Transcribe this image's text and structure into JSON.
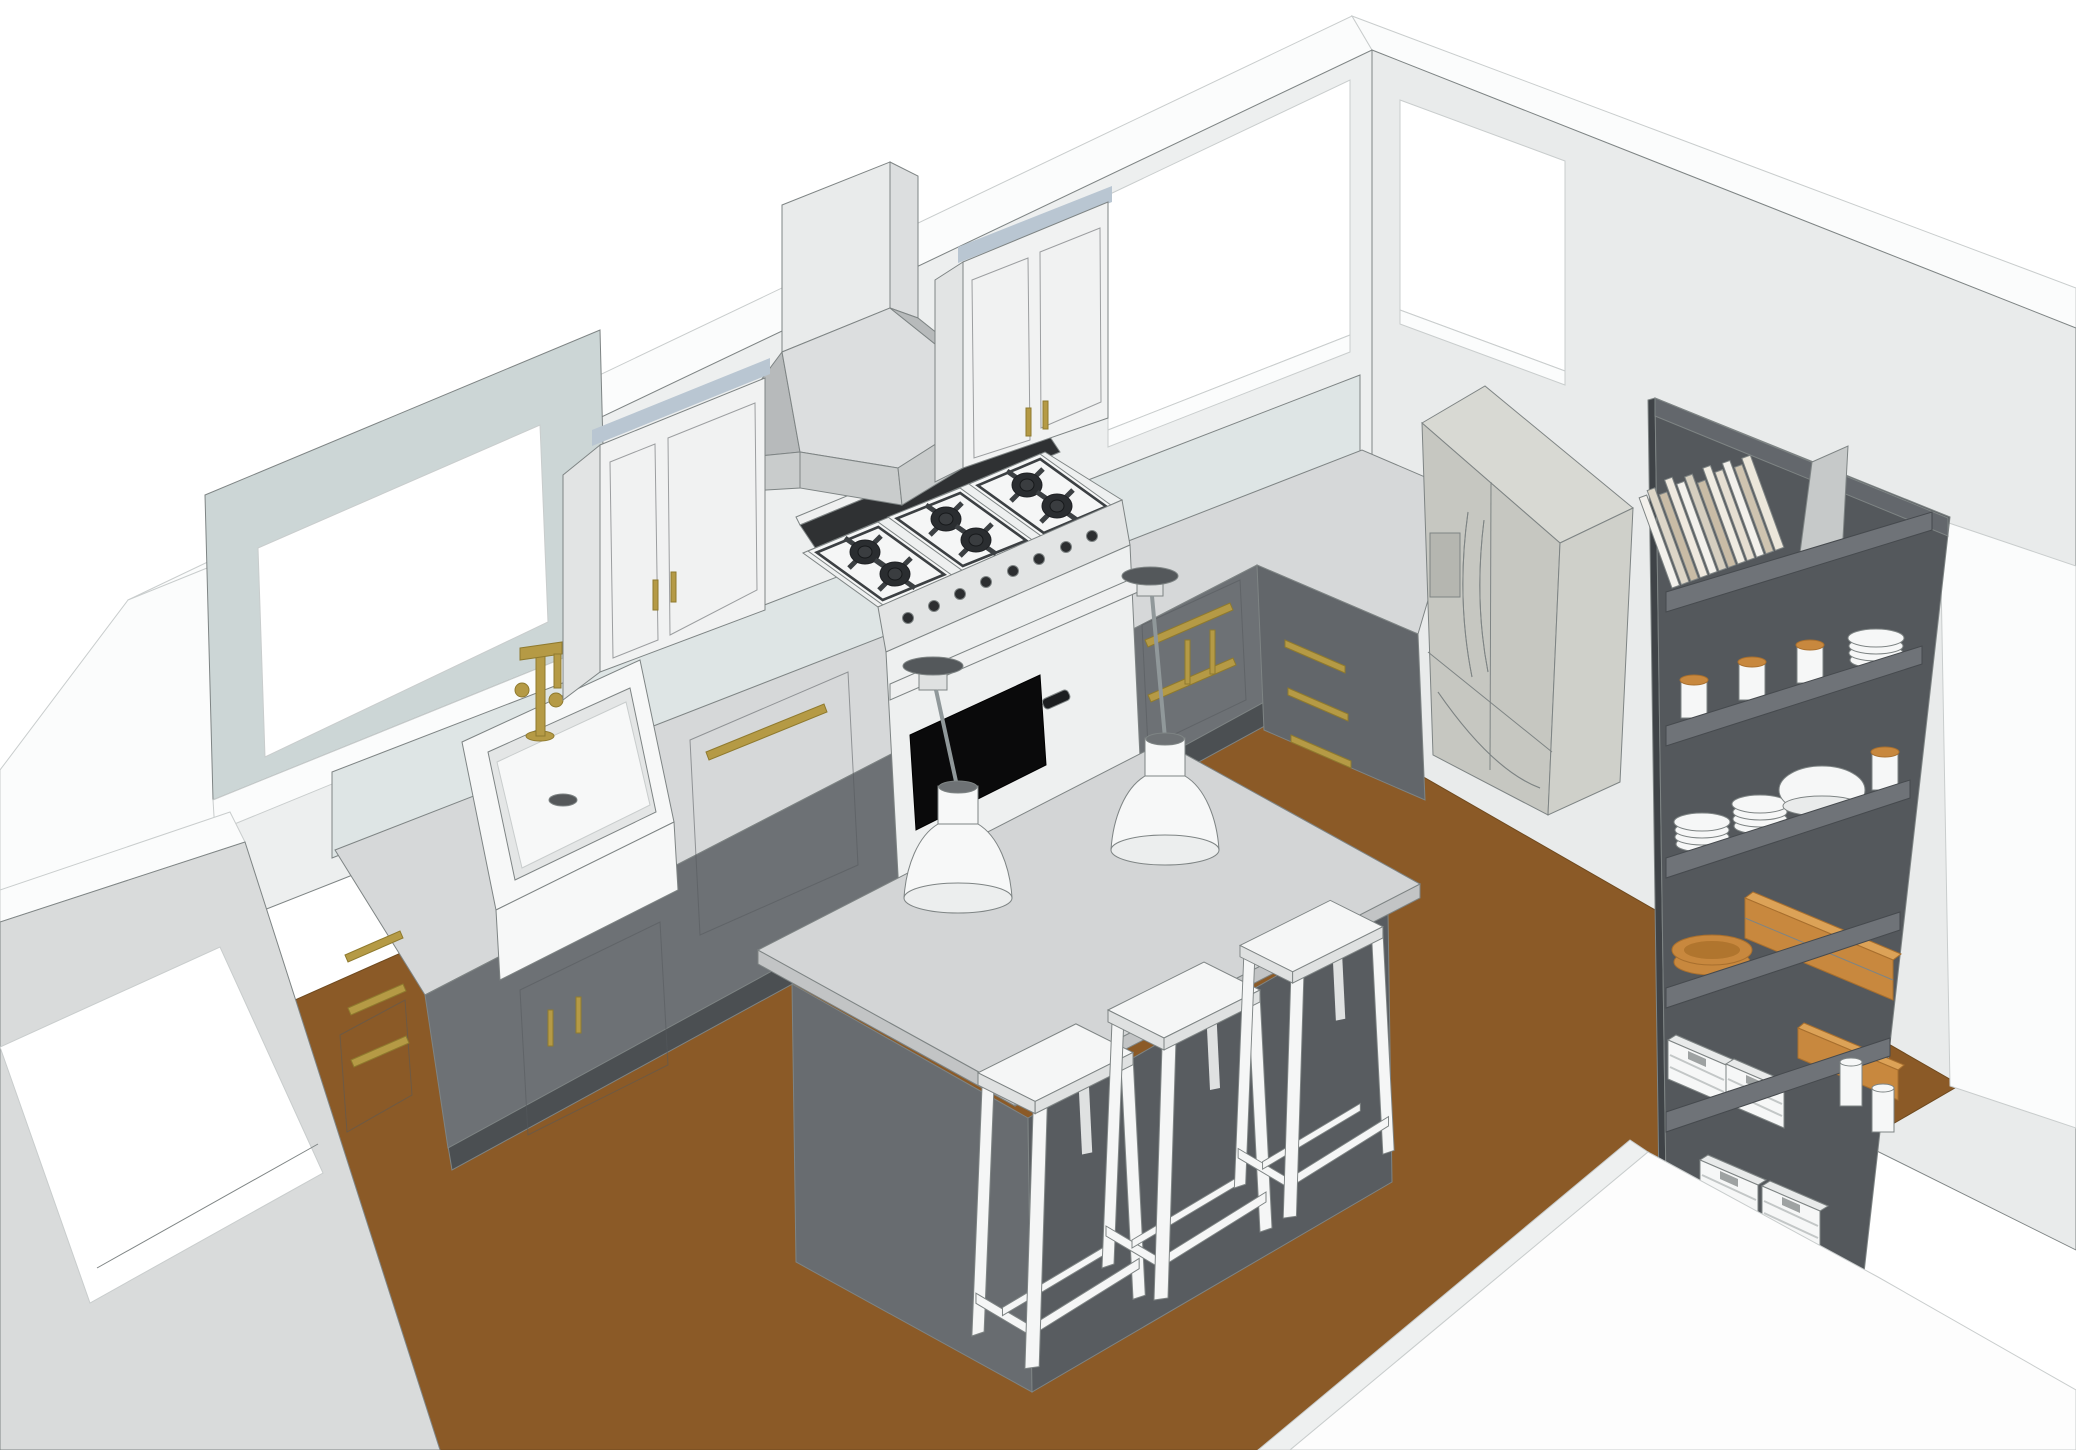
{
  "scene": {
    "type": "3d-interior-model-rendering",
    "room": "kitchen",
    "style": "flat-shaded architectural model, no textures, white background",
    "camera": "elevated three-quarter view into an L-shaped kitchen",
    "objects": [
      {
        "name": "window-left-wall",
        "label": "window over sink"
      },
      {
        "name": "window-back-wall",
        "label": "window beside upper cabinet"
      },
      {
        "name": "window-right-wall",
        "label": "window above refrigerator"
      },
      {
        "name": "window-front-wall",
        "label": "window in foreground wall"
      },
      {
        "name": "farmhouse-sink",
        "label": "white apron-front sink",
        "color": "#f7f8f8"
      },
      {
        "name": "wall-mount-faucet",
        "label": "brass bridge faucet",
        "finish": "#b59a45"
      },
      {
        "name": "upper-cabinet-left",
        "label": "white 2-door wall cabinet",
        "hardware": "brass"
      },
      {
        "name": "upper-cabinet-right",
        "label": "white 2-door wall cabinet",
        "hardware": "brass"
      },
      {
        "name": "range-hood",
        "label": "gray pyramid chimney hood"
      },
      {
        "name": "gas-range",
        "label": "36in range, 6 burners, oven with black glass"
      },
      {
        "name": "dishwasher-panel",
        "label": "gray panel with long brass pull"
      },
      {
        "name": "base-cabinets",
        "label": "L-shaped gray shaker cabinets, brass pulls"
      },
      {
        "name": "refrigerator",
        "label": "french-door fridge with water dispenser",
        "finish": "stainless gray"
      },
      {
        "name": "open-shelving-unit",
        "label": "dark gray bookcase, 6 levels",
        "contents": [
          "books",
          "leaning board",
          "canisters with wood lids",
          "plate stacks",
          "large bowl",
          "bread basket",
          "wood boxes",
          "white crates",
          "white jars"
        ]
      },
      {
        "name": "kitchen-island",
        "label": "island, gray top on dark gray base"
      },
      {
        "name": "bar-stool",
        "label": "white stool",
        "count": 3
      },
      {
        "name": "pendant-light",
        "label": "white dome pendant, dark canopy",
        "count": 2
      },
      {
        "name": "wood-floor",
        "label": "brown wood floor",
        "color": "#8b5a27"
      }
    ]
  },
  "colors": {
    "bg": "#ffffff",
    "line": "#7e8484",
    "wall_band": "#fbfcfc",
    "wall_left": "#edefef",
    "wall_right": "#e9ebeb",
    "wall_exterior": "#d9dbdb",
    "backsplash": "#dee5e5",
    "window_jamb": "#ccd6d6",
    "glass": "#ffffff",
    "crown": "#b9c6d2",
    "upper_cab": "#f1f2f2",
    "upper_cab_side": "#e2e4e4",
    "cab_gray": "#6d7175",
    "cab_gray_dark": "#62666a",
    "toe_kick": "#4b4f52",
    "counter": "#d6d8d9",
    "brass": "#b59a45",
    "sink_white": "#f7f8f8",
    "sink_shadow": "#e4e6e6",
    "range_body": "#eef0f0",
    "range_panel": "#e2e4e4",
    "rail_dark": "#2f3133",
    "module": "#f5f6f6",
    "grate": "#3c4043",
    "burner": "#2a2d30",
    "oven_glass": "#0a0a0b",
    "steel": "#eff0f0",
    "hood_front": "#dcdedf",
    "hood_light": "#e9ebeb",
    "hood_dark": "#b7babb",
    "hood_rim": "#c9cccc",
    "fridge_front": "#c6c7c1",
    "fridge_side": "#cfd0ca",
    "fridge_top": "#d8d9d3",
    "fridge_detail": "#b5b6b0",
    "shelf_front": "#54585c",
    "shelf_side": "#3f4347",
    "shelf_band": "#6f7378",
    "shelf_top": "#63676c",
    "wood": "#c8883e",
    "wood_light": "#dca257",
    "wood_dark": "#a86f2e",
    "white_item": "#f6f7f7",
    "floor": "#8b5a27",
    "island_top": "#d3d5d6",
    "island_edge": "#c2c4c5",
    "island_left": "#686c70",
    "island_right": "#585c60",
    "stool": "#f5f6f6",
    "stool_dark": "#dfe1e1",
    "pendant": "#f7f8f8",
    "pendant_cup": "#dfe1e1",
    "canopy": "#54585b",
    "cord": "#90989a",
    "hole": "#6e7275"
  }
}
